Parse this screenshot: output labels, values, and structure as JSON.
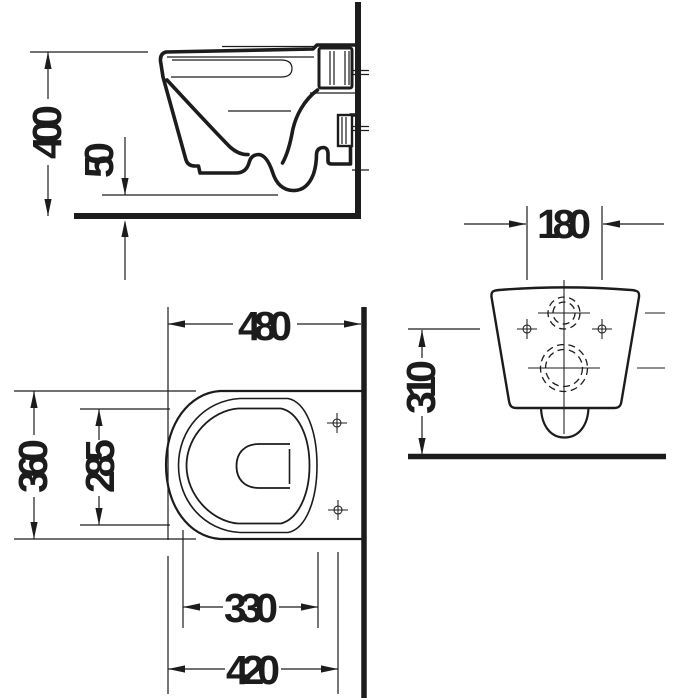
{
  "colors": {
    "ink": "#1c1c1c",
    "background": "#ffffff"
  },
  "views": {
    "side": {
      "dim_seat_height": "400",
      "dim_bottom_clearance": "50"
    },
    "plan": {
      "dim_depth": "480",
      "dim_overall_width": "360",
      "dim_bowl_width": "285",
      "dim_bowl_length": "330",
      "dim_front_to_fixings": "420"
    },
    "rear": {
      "dim_fixing_hole_spacing": "180",
      "dim_fixing_height": "310"
    }
  }
}
